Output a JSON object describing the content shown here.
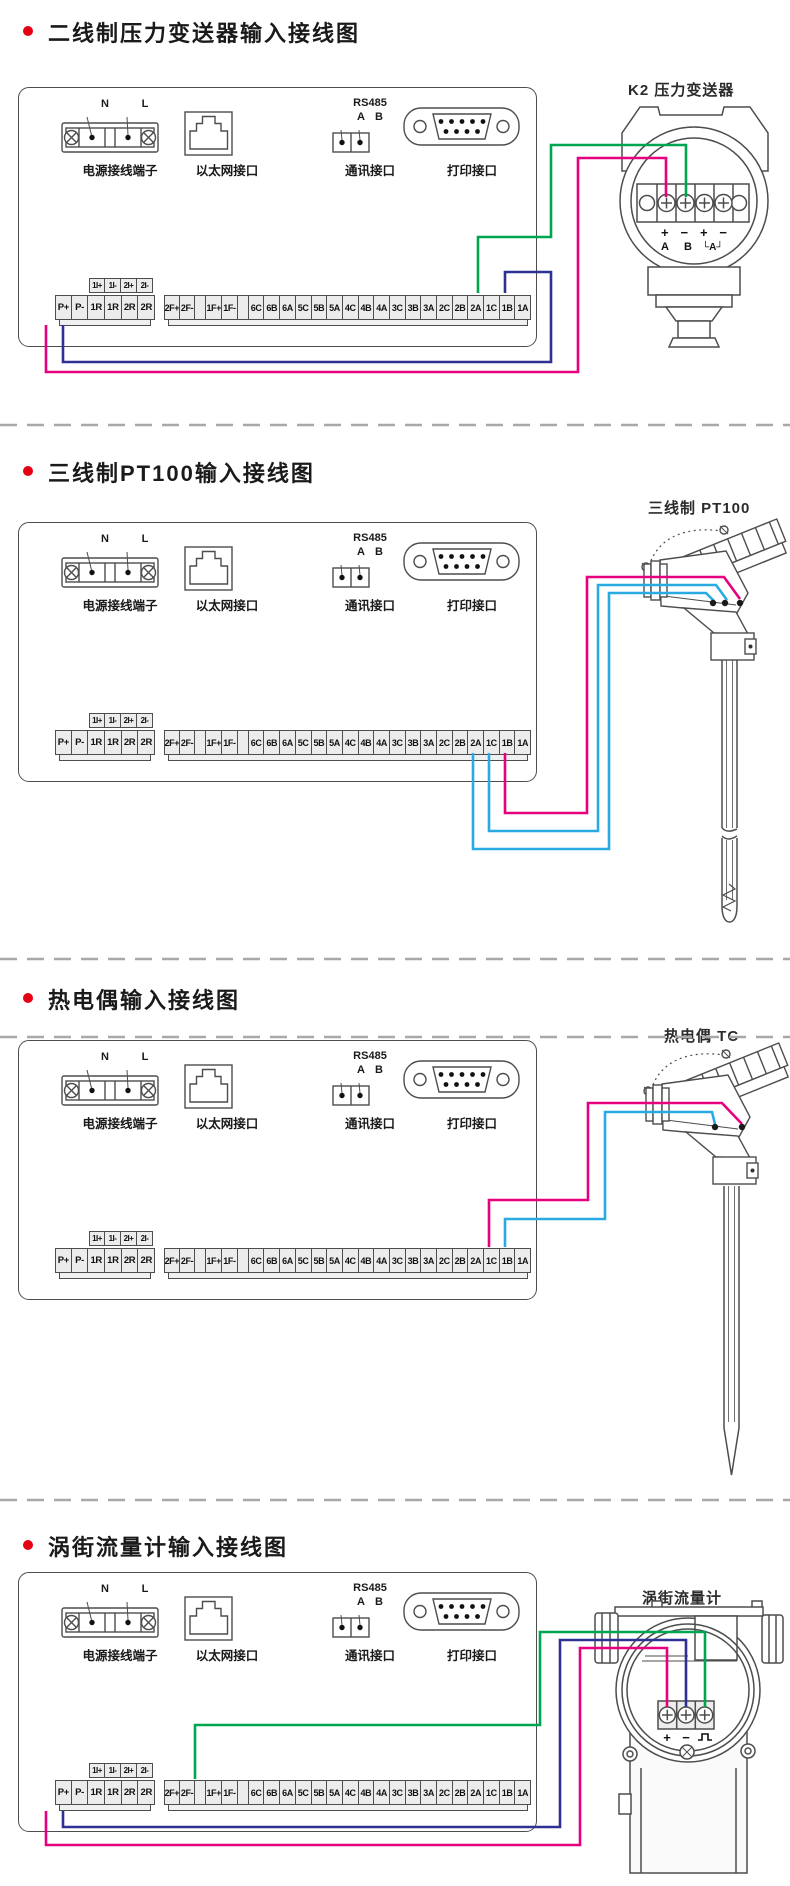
{
  "colors": {
    "magenta": "#e6007e",
    "blue": "#2e3192",
    "cyan": "#29abe2",
    "green": "#00a551",
    "bullet_red": "#e60012",
    "outline_gray": "#4d4d4d",
    "dash_gray": "#a8a8a8"
  },
  "panel": {
    "power_n": "N",
    "power_l": "L",
    "rs485": "RS485",
    "rs485_a": "A",
    "rs485_b": "B",
    "power_label": "电源接线端子",
    "ethernet_label": "以太网接口",
    "comm_label": "通讯接口",
    "print_label": "打印接口",
    "strip_header": [
      "1I+",
      "1I-",
      "2I+",
      "2I-"
    ],
    "strip_left": [
      "P+",
      "P-",
      "1R",
      "1R",
      "2R",
      "2R"
    ],
    "strip_right": [
      "2F+",
      "2F-",
      "",
      "1F+",
      "1F-",
      "",
      "6C",
      "6B",
      "6A",
      "5C",
      "5B",
      "5A",
      "4C",
      "4B",
      "4A",
      "3C",
      "3B",
      "3A",
      "2C",
      "2B",
      "2A",
      "1C",
      "1B",
      "1A"
    ]
  },
  "sections": [
    {
      "title": "二线制压力变送器输入接线图",
      "device_label": "K2  压力变送器",
      "terminal_row1": "+ − + −",
      "terminal_row2": "A B",
      "terminal_row2b": "└A┘",
      "wires": [
        {
          "color": "green",
          "from": "1C",
          "to": "变送器 B−"
        },
        {
          "color": "magenta",
          "from": "P+",
          "to": "变送器 A+"
        },
        {
          "color": "blue",
          "from": "P−",
          "to": "1A"
        }
      ]
    },
    {
      "title": "三线制PT100输入接线图",
      "device_label": "三线制  PT100",
      "wires": [
        {
          "color": "magenta",
          "from": "1A",
          "to": "PT100 右端子"
        },
        {
          "color": "cyan",
          "from": "1B",
          "to": "PT100 中端子"
        },
        {
          "color": "cyan",
          "from": "1C",
          "to": "PT100 左端子"
        }
      ]
    },
    {
      "title": "热电偶输入接线图",
      "device_label": "热电偶  TC",
      "wires": [
        {
          "color": "magenta",
          "from": "1B",
          "to": "TC 右端子"
        },
        {
          "color": "cyan",
          "from": "1A",
          "to": "TC 左端子"
        }
      ]
    },
    {
      "title": "涡街流量计输入接线图",
      "device_label": "涡街流量计",
      "terminal_plus": "+",
      "terminal_minus": "−",
      "wires": [
        {
          "color": "green",
          "from": "1F+",
          "to": "脉冲端子"
        },
        {
          "color": "blue",
          "from": "P−",
          "to": "− 端子"
        },
        {
          "color": "magenta",
          "from": "P+",
          "to": "+ 端子"
        }
      ]
    }
  ]
}
